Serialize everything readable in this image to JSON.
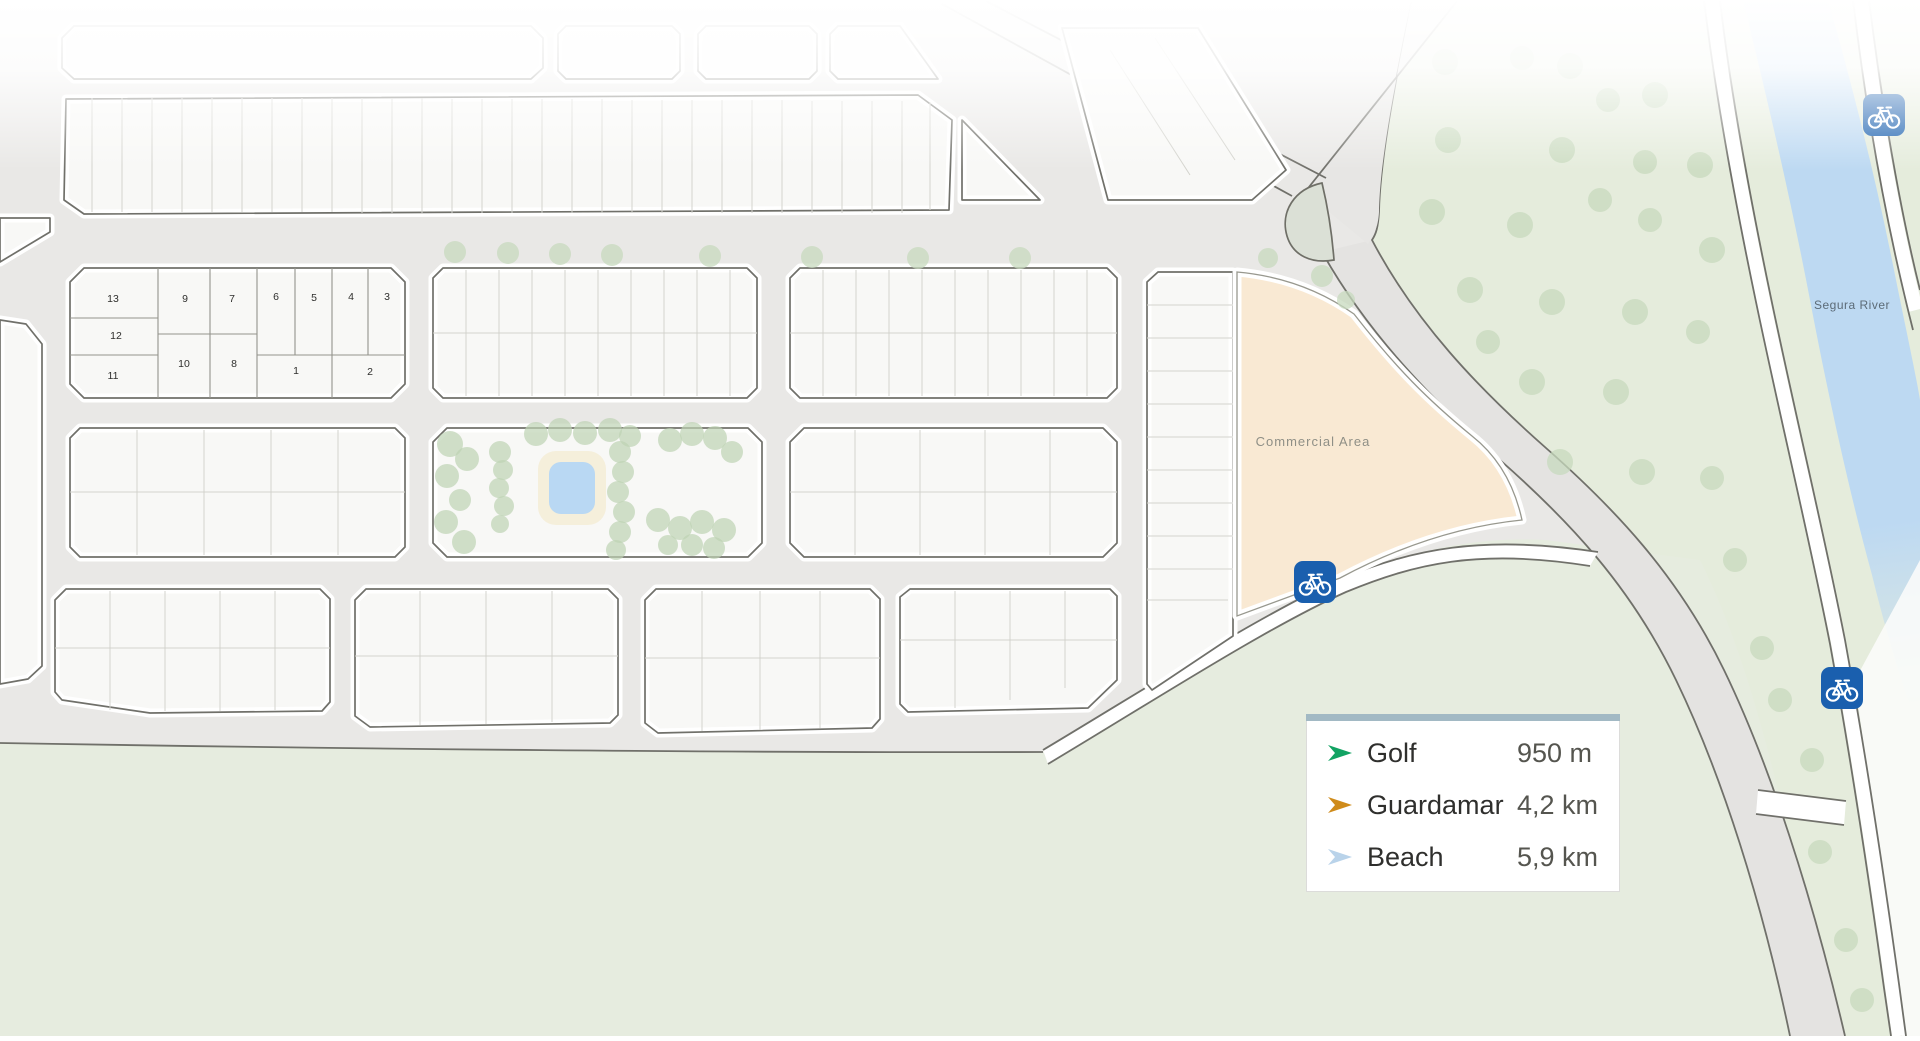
{
  "labels": {
    "commercial_area": "Commercial Area",
    "river": "Segura River"
  },
  "plots": {
    "n1": "1",
    "n2": "2",
    "n3": "3",
    "n4": "4",
    "n5": "5",
    "n6": "6",
    "n7": "7",
    "n8": "8",
    "n9": "9",
    "n10": "10",
    "n11": "11",
    "n12": "12",
    "n13": "13"
  },
  "legend": {
    "items": [
      {
        "label": "Golf",
        "distance": "950 m",
        "color": "#12a363"
      },
      {
        "label": "Guardamar",
        "distance": "4,2 km",
        "color": "#cf8b1b"
      },
      {
        "label": "Beach",
        "distance": "5,9 km",
        "color": "#b9d3ea"
      }
    ]
  },
  "icons": {
    "bike_route": "bicycle-route-sign"
  },
  "colors": {
    "bike_sign": "#1a5fae",
    "river": "#bdd9f2",
    "commercial": "#f9e9d3",
    "park": "#e3ebdc",
    "green_area": "#e5ecdc",
    "green_bottom": "#e6ecdf",
    "legend_header": "#a2b9c4",
    "street": "#e9e8e6",
    "island": "#dbe0d6"
  }
}
